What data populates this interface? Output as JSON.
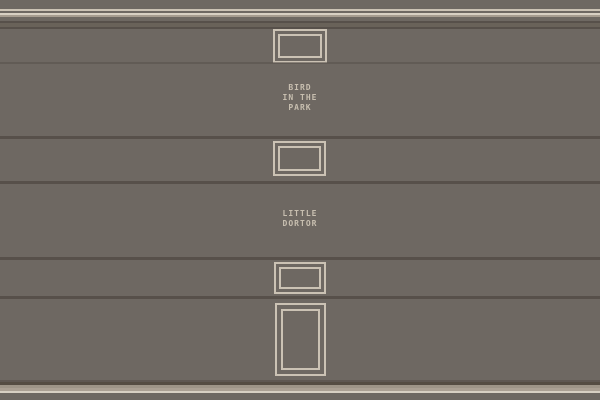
{
  "scene_title": "pixel building facade",
  "colors": {
    "background": "#6e6862",
    "frame": "#cbc2b4",
    "bright": "#d8d0c3",
    "mid": "#a79d90",
    "groove": "#57504a",
    "band": "#696259",
    "base_trans": "#5f5751",
    "base_dark": "#554c42",
    "base_mid1": "#9e9487",
    "base_mid2": "#aba093",
    "text": "#c8bfb0"
  },
  "signs": {
    "bird": {
      "line1": "BIRD",
      "line2": "IN THE",
      "line3": "PARK"
    },
    "dortor": {
      "line1": "LITTLE",
      "line2": "DORTOR"
    }
  }
}
